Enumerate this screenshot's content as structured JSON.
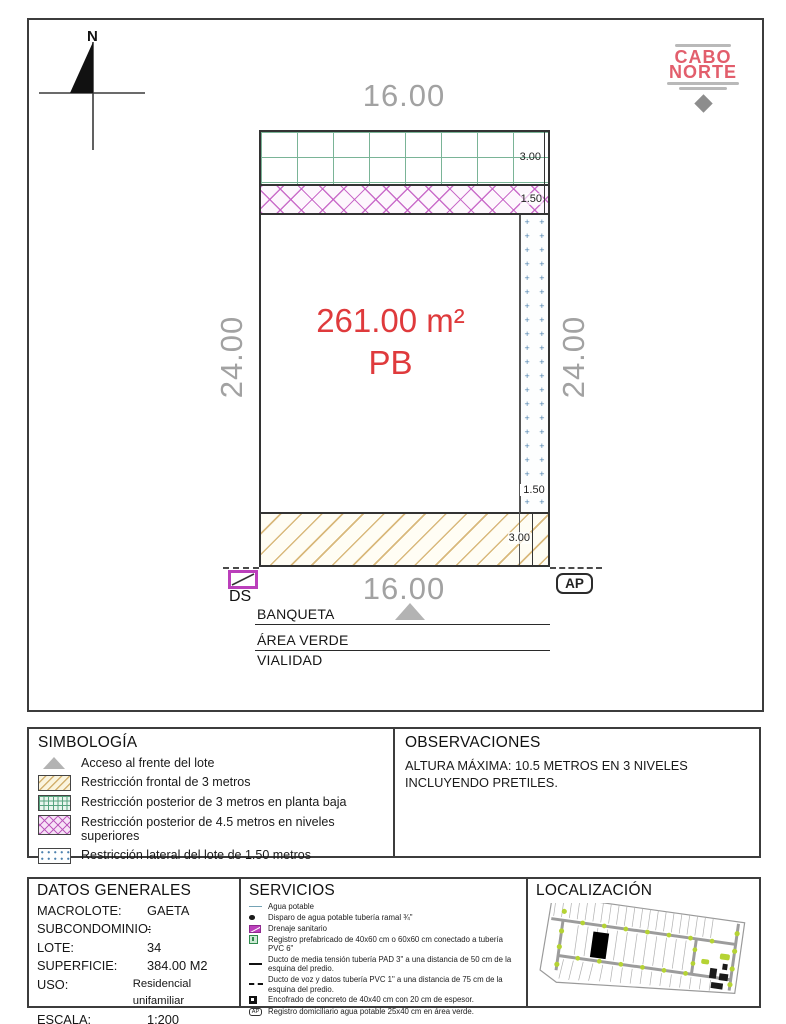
{
  "logo": {
    "line1": "CABO",
    "line2": "NORTE"
  },
  "north": {
    "label": "N"
  },
  "plan": {
    "dim_top": "16.00",
    "dim_bottom": "16.00",
    "dim_left": "24.00",
    "dim_right": "24.00",
    "dim_rear_strip": "3.00",
    "dim_upper_strip": "1.50",
    "dim_lateral_strip": "1.50",
    "dim_front_strip": "3.00",
    "area_label": "261.00 m²",
    "level_label": "PB",
    "ds_label": "DS",
    "ap_label": "AP",
    "street_labels": [
      "BANQUETA",
      "ÁREA VERDE",
      "VIALIDAD"
    ]
  },
  "simbologia": {
    "title": "SIMBOLOGÍA",
    "items": [
      {
        "icon": "access-triangle",
        "label": "Acceso al frente del lote"
      },
      {
        "icon": "front-hatch-swatch",
        "label": "Restricción frontal de 3 metros"
      },
      {
        "icon": "rear-grid-swatch",
        "label": "Restricción posterior de 3 metros en planta baja"
      },
      {
        "icon": "upper-cross-swatch",
        "label": "Restricción posterior de 4.5 metros en niveles superiores"
      },
      {
        "icon": "lateral-dots-swatch",
        "label": "Restricción lateral del lote de 1.50 metros"
      }
    ]
  },
  "observaciones": {
    "title": "OBSERVACIONES",
    "lines": [
      "ALTURA MÁXIMA: 10.5 METROS EN 3 NIVELES",
      "INCLUYENDO PRETILES."
    ]
  },
  "datos_generales": {
    "title": "DATOS GENERALES",
    "rows": [
      {
        "label": "MACROLOTE:",
        "value": "GAETA"
      },
      {
        "label": "SUBCONDOMINIO:",
        "value": "-"
      },
      {
        "label": "LOTE:",
        "value": "34"
      },
      {
        "label": "SUPERFICIE:",
        "value": "384.00 M2"
      },
      {
        "label": "USO:",
        "value": "Residencial unifamiliar"
      },
      {
        "label": "ESCALA:",
        "value": "1:200"
      }
    ]
  },
  "servicios": {
    "title": "SERVICIOS",
    "items": [
      {
        "icon": "water-line",
        "label": "Agua potable"
      },
      {
        "icon": "tap-dot",
        "label": "Disparo de agua potable tubería ramal ¾\""
      },
      {
        "icon": "sewer-box",
        "label": "Drenaje sanitario"
      },
      {
        "icon": "register-box",
        "label": "Registro prefabricado de 40x60 cm o 60x60 cm conectado a tubería PVC 6\""
      },
      {
        "icon": "solid-duct-line",
        "label": "Ducto de media tensión tubería PAD 3\" a una distancia de 50 cm de la esquina del predio."
      },
      {
        "icon": "dashed-duct-line",
        "label": "Ducto de voz y datos tubería PVC 1\" a una distancia de 75 cm de la esquina del predio."
      },
      {
        "icon": "concrete-square",
        "label": "Encofrado de concreto de 40x40 cm con 20 cm de espesor."
      },
      {
        "icon": "ap-register",
        "label": "Registro domiciliario agua potable 25x40 cm en área verde.",
        "icon_text": "AP"
      }
    ]
  },
  "localizacion": {
    "title": "LOCALIZACIÓN"
  },
  "colors": {
    "brand_red": "#e25e6c",
    "area_text_red": "#df3a3c",
    "dimension_gray": "#a2a2a2",
    "rear_grid_green": "#7ab497",
    "upper_cross_magenta": "#c55fc5",
    "front_hatch_tan": "#d9b97c",
    "lateral_plus_blue": "#4b80ad",
    "map_green": "#b5d334"
  }
}
